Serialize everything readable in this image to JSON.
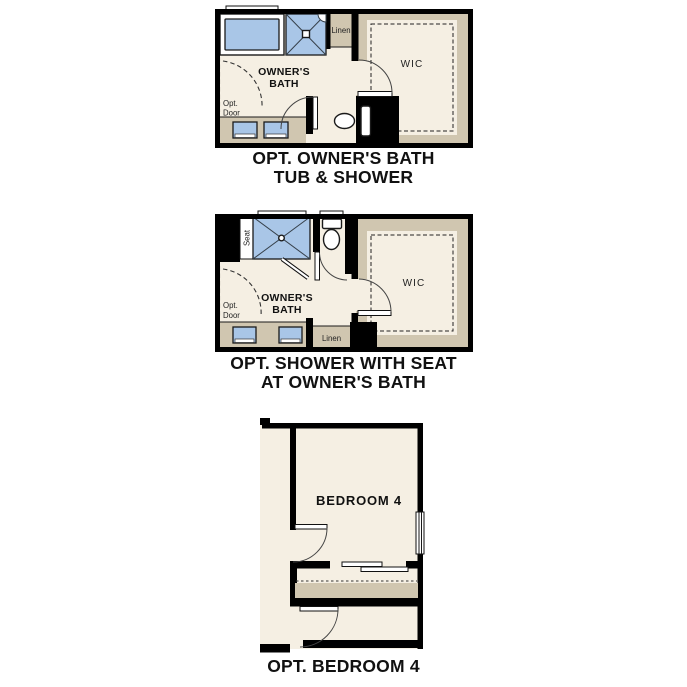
{
  "colors": {
    "floor": "#f5efe3",
    "millwork": "#d0c6b0",
    "fixture_blue": "#a9c6e7",
    "wall": "#000000",
    "line": "#1a1a1a",
    "text": "#111111"
  },
  "plans": [
    {
      "caption_line1": "OPT. OWNER'S BATH",
      "caption_line2": "TUB & SHOWER",
      "labels": {
        "room_line1": "OWNER'S",
        "room_line2": "BATH",
        "wic": "WIC",
        "linen": "Linen",
        "opt_line1": "Opt.",
        "opt_line2": "Door"
      }
    },
    {
      "caption_line1": "OPT. SHOWER WITH SEAT",
      "caption_line2": "AT OWNER'S BATH",
      "labels": {
        "room_line1": "OWNER'S",
        "room_line2": "BATH",
        "wic": "WIC",
        "linen": "Linen",
        "seat": "Seat",
        "opt_line1": "Opt.",
        "opt_line2": "Door"
      }
    },
    {
      "caption_line1": "OPT. BEDROOM 4",
      "labels": {
        "room": "BEDROOM 4"
      }
    }
  ]
}
